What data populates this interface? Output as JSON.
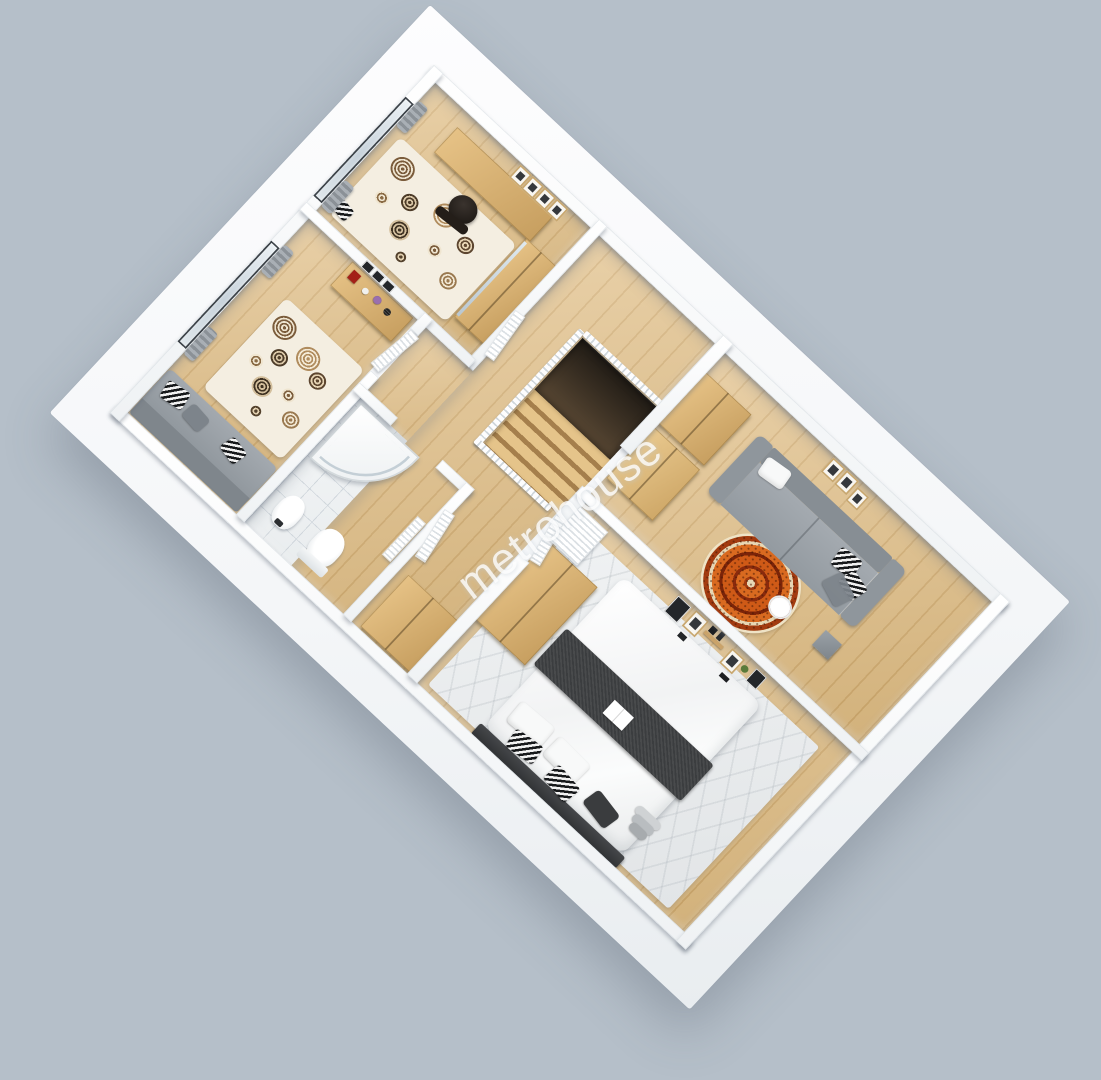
{
  "image": {
    "kind": "3d-floor-plan-render",
    "width_px": 1101,
    "height_px": 1080
  },
  "watermark": {
    "text": "metrohouse",
    "color": "#ffffff"
  },
  "background": {
    "color": "#b5bfc9"
  },
  "palette": {
    "slab_wall_white": "#f7f9fa",
    "wood_floor": "#ddbb80",
    "cabinet_wood": "#d6ad6e",
    "sofa_gray": "#9aa1a7",
    "charcoal": "#3c3e40",
    "rug_orange": "#cf5a17",
    "rug_cream": "#eadcba",
    "bathroom_tile": "#eef0f2",
    "curtain_gray": "#99a0a6",
    "window_glass": "#cdd8e0"
  },
  "rooms": [
    {
      "name": "Office",
      "floor": "wood",
      "furniture": [
        "desk",
        "office-chair",
        "wardrobe-with-mirror",
        "spiral-rug",
        "picture-frames",
        "window-with-curtains",
        "chevron-pouf"
      ]
    },
    {
      "name": "Bedroom",
      "floor": "wood",
      "furniture": [
        "daybed-sofa",
        "zigzag-pillows",
        "spiral-rug",
        "dresser",
        "red-box",
        "vases-and-flowers",
        "picture-frames",
        "window-with-curtains"
      ]
    },
    {
      "name": "Bathroom",
      "floor": "tile",
      "furniture": [
        "corner-shower",
        "toilet",
        "bidet",
        "louvered-door"
      ]
    },
    {
      "name": "Hallway",
      "floor": "wood",
      "furniture": [
        "staircase-void",
        "wooden-steps",
        "white-railing",
        "wardrobe",
        "louvered-doors"
      ]
    },
    {
      "name": "Living Room",
      "floor": "wood",
      "furniture": [
        "gray-sofa",
        "white-pillow",
        "zigzag-pillows",
        "round-oriental-rug",
        "double-wardrobe",
        "round-side-table",
        "cube-side-table",
        "picture-frames"
      ]
    },
    {
      "name": "Master Bedroom",
      "floor": "wood",
      "furniture": [
        "double-bed",
        "charcoal-throw",
        "pillows",
        "zigzag-pillows",
        "headboard",
        "area-rug",
        "wardrobe",
        "louvered-closet-door",
        "wall-shelves-decor",
        "open-magazine",
        "step-stool"
      ]
    }
  ]
}
